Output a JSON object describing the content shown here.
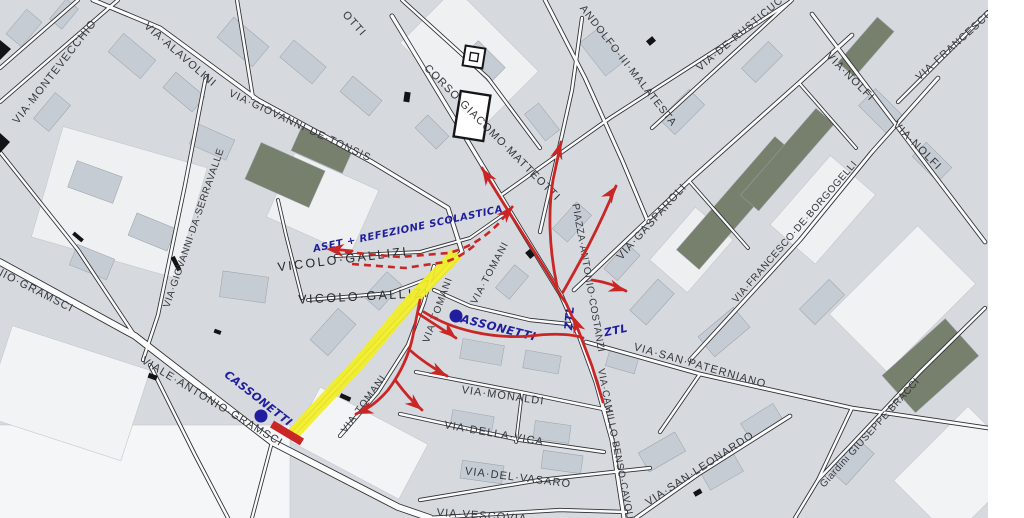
{
  "map": {
    "type": "scanned-city-street-map",
    "colors": {
      "background": "#ffffff",
      "land": "#d6dade",
      "block": "#c6ccd3",
      "dark_block": "#76806c",
      "road_casing": "#2a2d31",
      "road_fill": "#fbfbfc",
      "street_label": "#34373c",
      "street_label_dark": "#26282d",
      "annotation_red": "#cb2626",
      "annotation_blue": "#201d9e",
      "highlight_yellow": "#f2ee25"
    },
    "street_labels": [
      {
        "text": "VIA·MONTEVECCHIO",
        "x": 55,
        "y": 72,
        "rot": -52,
        "size": 11
      },
      {
        "text": "VIA·ALAVOLINI",
        "x": 180,
        "y": 55,
        "rot": 41,
        "size": 11
      },
      {
        "text": "VIA·GIOVANNI·DE·TONSIS",
        "x": 300,
        "y": 126,
        "rot": 25,
        "size": 10.5
      },
      {
        "text": "OTTI",
        "x": 354,
        "y": 24,
        "rot": 48,
        "size": 11
      },
      {
        "text": "CORSO·GIACOMO·MATTEOTTI",
        "x": 492,
        "y": 133,
        "rot": 45,
        "size": 11
      },
      {
        "text": "ANDOLFO·III·MALATESTA",
        "x": 628,
        "y": 66,
        "rot": 52,
        "size": 10.5
      },
      {
        "text": "VIA·DE·RUSTICUCCI",
        "x": 745,
        "y": 30,
        "rot": -40,
        "size": 10.5
      },
      {
        "text": "VIA·NOLFI",
        "x": 850,
        "y": 77,
        "rot": 45,
        "size": 11
      },
      {
        "text": "VIA·FRANCESCO",
        "x": 955,
        "y": 45,
        "rot": -42,
        "size": 10.5
      },
      {
        "text": "VIA·NOLFI",
        "x": 917,
        "y": 146,
        "rot": 45,
        "size": 11
      },
      {
        "text": "VIA·FRANCESCO·DE·BORGOGELLI",
        "x": 795,
        "y": 232,
        "rot": -49,
        "size": 10,
        "cls": "tight"
      },
      {
        "text": "VIA·GASPAROLI",
        "x": 652,
        "y": 222,
        "rot": -48,
        "size": 11
      },
      {
        "text": "PIAZZA·ANTONIO·COSTANZI",
        "x": 588,
        "y": 278,
        "rot": 80,
        "size": 10,
        "cls": "tight"
      },
      {
        "text": "VIA·SAN·PATERNIANO",
        "x": 700,
        "y": 366,
        "rot": 16,
        "size": 11
      },
      {
        "text": "VIA·SAN·LEONARDO",
        "x": 700,
        "y": 469,
        "rot": -33,
        "size": 11
      },
      {
        "text": "Giardini GIUSEPPE BRACCI",
        "x": 870,
        "y": 433,
        "rot": -48,
        "size": 10,
        "cls": "tight"
      },
      {
        "text": "VIA·MONALDI",
        "x": 503,
        "y": 396,
        "rot": 8,
        "size": 11
      },
      {
        "text": "VIA·DELLA·VICA",
        "x": 494,
        "y": 434,
        "rot": 10,
        "size": 11
      },
      {
        "text": "VIA·DEL·VASARO",
        "x": 518,
        "y": 478,
        "rot": 7,
        "size": 11
      },
      {
        "text": "VIA·VESCOVIA",
        "x": 482,
        "y": 516,
        "rot": 4,
        "size": 11
      },
      {
        "text": "VIA·CAMILLO·BENSO·CAVOUR",
        "x": 616,
        "y": 448,
        "rot": 79,
        "size": 10,
        "cls": "tight"
      },
      {
        "text": "VIA·TOMANI",
        "x": 490,
        "y": 273,
        "rot": -62,
        "size": 10
      },
      {
        "text": "VIA·TOMANI",
        "x": 438,
        "y": 310,
        "rot": -70,
        "size": 10
      },
      {
        "text": "VIA·TOMANI",
        "x": 364,
        "y": 404,
        "rot": -54,
        "size": 10
      },
      {
        "text": "NIO·GRAMSCI",
        "x": 34,
        "y": 290,
        "rot": 27,
        "size": 11
      },
      {
        "text": "VIALE·ANTONIO·GRAMSCI",
        "x": 212,
        "y": 402,
        "rot": 31,
        "size": 11
      },
      {
        "text": "VIA·GIOVANNI·DA·SERRAVALLE",
        "x": 194,
        "y": 228,
        "rot": -71,
        "size": 10,
        "cls": "tight"
      },
      {
        "text": "VICOLO·GALLIZI",
        "x": 343,
        "y": 260,
        "rot": -7,
        "size": 12.5,
        "cls": "big"
      },
      {
        "text": "VICOLO·GALLIZI",
        "x": 364,
        "y": 297,
        "rot": -3,
        "size": 12.5,
        "cls": "big"
      }
    ],
    "overlay_labels": [
      {
        "text": "ASET + REFEZIONE SCOLASTICA",
        "x": 408,
        "y": 229,
        "rot": -12,
        "size": 10,
        "cls": "blue"
      },
      {
        "text": "CASSONETTI",
        "x": 494,
        "y": 327,
        "rot": 14,
        "size": 11.5,
        "cls": "blue"
      },
      {
        "text": "CASSONETTI",
        "x": 258,
        "y": 399,
        "rot": 38,
        "size": 11,
        "cls": "blue"
      },
      {
        "text": "ZTL",
        "x": 570,
        "y": 318,
        "rot": -85,
        "size": 11,
        "cls": "blue"
      },
      {
        "text": "ZTL",
        "x": 616,
        "y": 331,
        "rot": -12,
        "size": 11,
        "cls": "blue"
      }
    ],
    "cassonetti_dots": [
      {
        "x": 456,
        "y": 316
      },
      {
        "x": 261,
        "y": 416
      }
    ]
  }
}
